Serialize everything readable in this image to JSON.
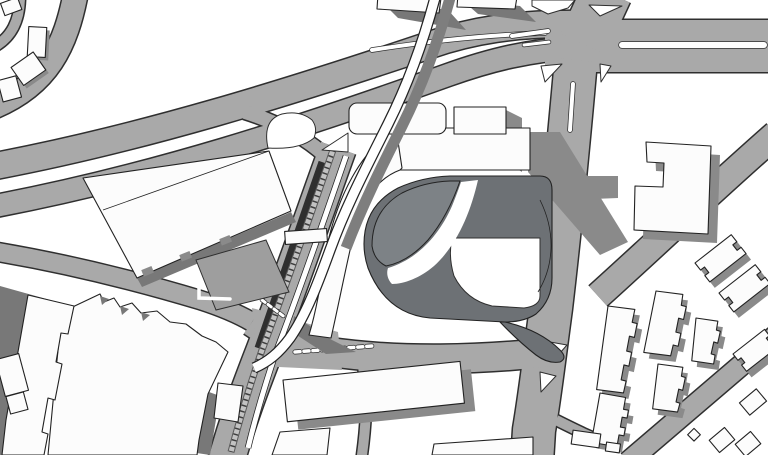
{
  "meta": {
    "type": "architectural-site-plan",
    "description": "Grayscale axonometric-shadow site plan: white building massing with gray drop shadows on a white ground, gray road network",
    "text_content": "none — the drawing contains no visible text or labels"
  },
  "colors": {
    "bg": "#ffffff",
    "white": "#ffffff",
    "road": "#a9a9a9",
    "casing": "#2f2f2f",
    "bfill": "#fcfcfc",
    "bstroke": "#222222",
    "shadow": "#8a8a8a",
    "shadow2": "#787878",
    "podium": "#6d7175",
    "garden": "#7d8286",
    "parking": "#9e9e9e",
    "railbed": "#5a5a5a",
    "raillight": "#c2c2c2",
    "railtie": "#3e3e3e",
    "rampshadow": "#7e7e7e"
  },
  "features": [
    {
      "id": "highway",
      "desc": "curved dual-carriageway sweeping from left edge to upper right"
    },
    {
      "id": "main-intersection",
      "desc": "large signalized crossroads top right with triangular islands and white median stripes"
    },
    {
      "id": "landmark-building",
      "desc": "central white slab with curved arm sweeping to a point over a dark podium with rounded courtyard"
    },
    {
      "id": "rail-corridor",
      "desc": "diagonal rail line with tie hatching and elevated white ramp crossing the highway"
    },
    {
      "id": "big-box-store",
      "desc": "large rotated rectangular building left of center with parking lot"
    },
    {
      "id": "industrial-complex",
      "desc": "jagged-edged white industrial buildings lower left with dark shadows"
    },
    {
      "id": "apartment-blocks",
      "desc": "crenellated residential slabs lower right with drop shadows"
    },
    {
      "id": "long-slab-building",
      "desc": "long tilted white slab building bottom center"
    }
  ]
}
